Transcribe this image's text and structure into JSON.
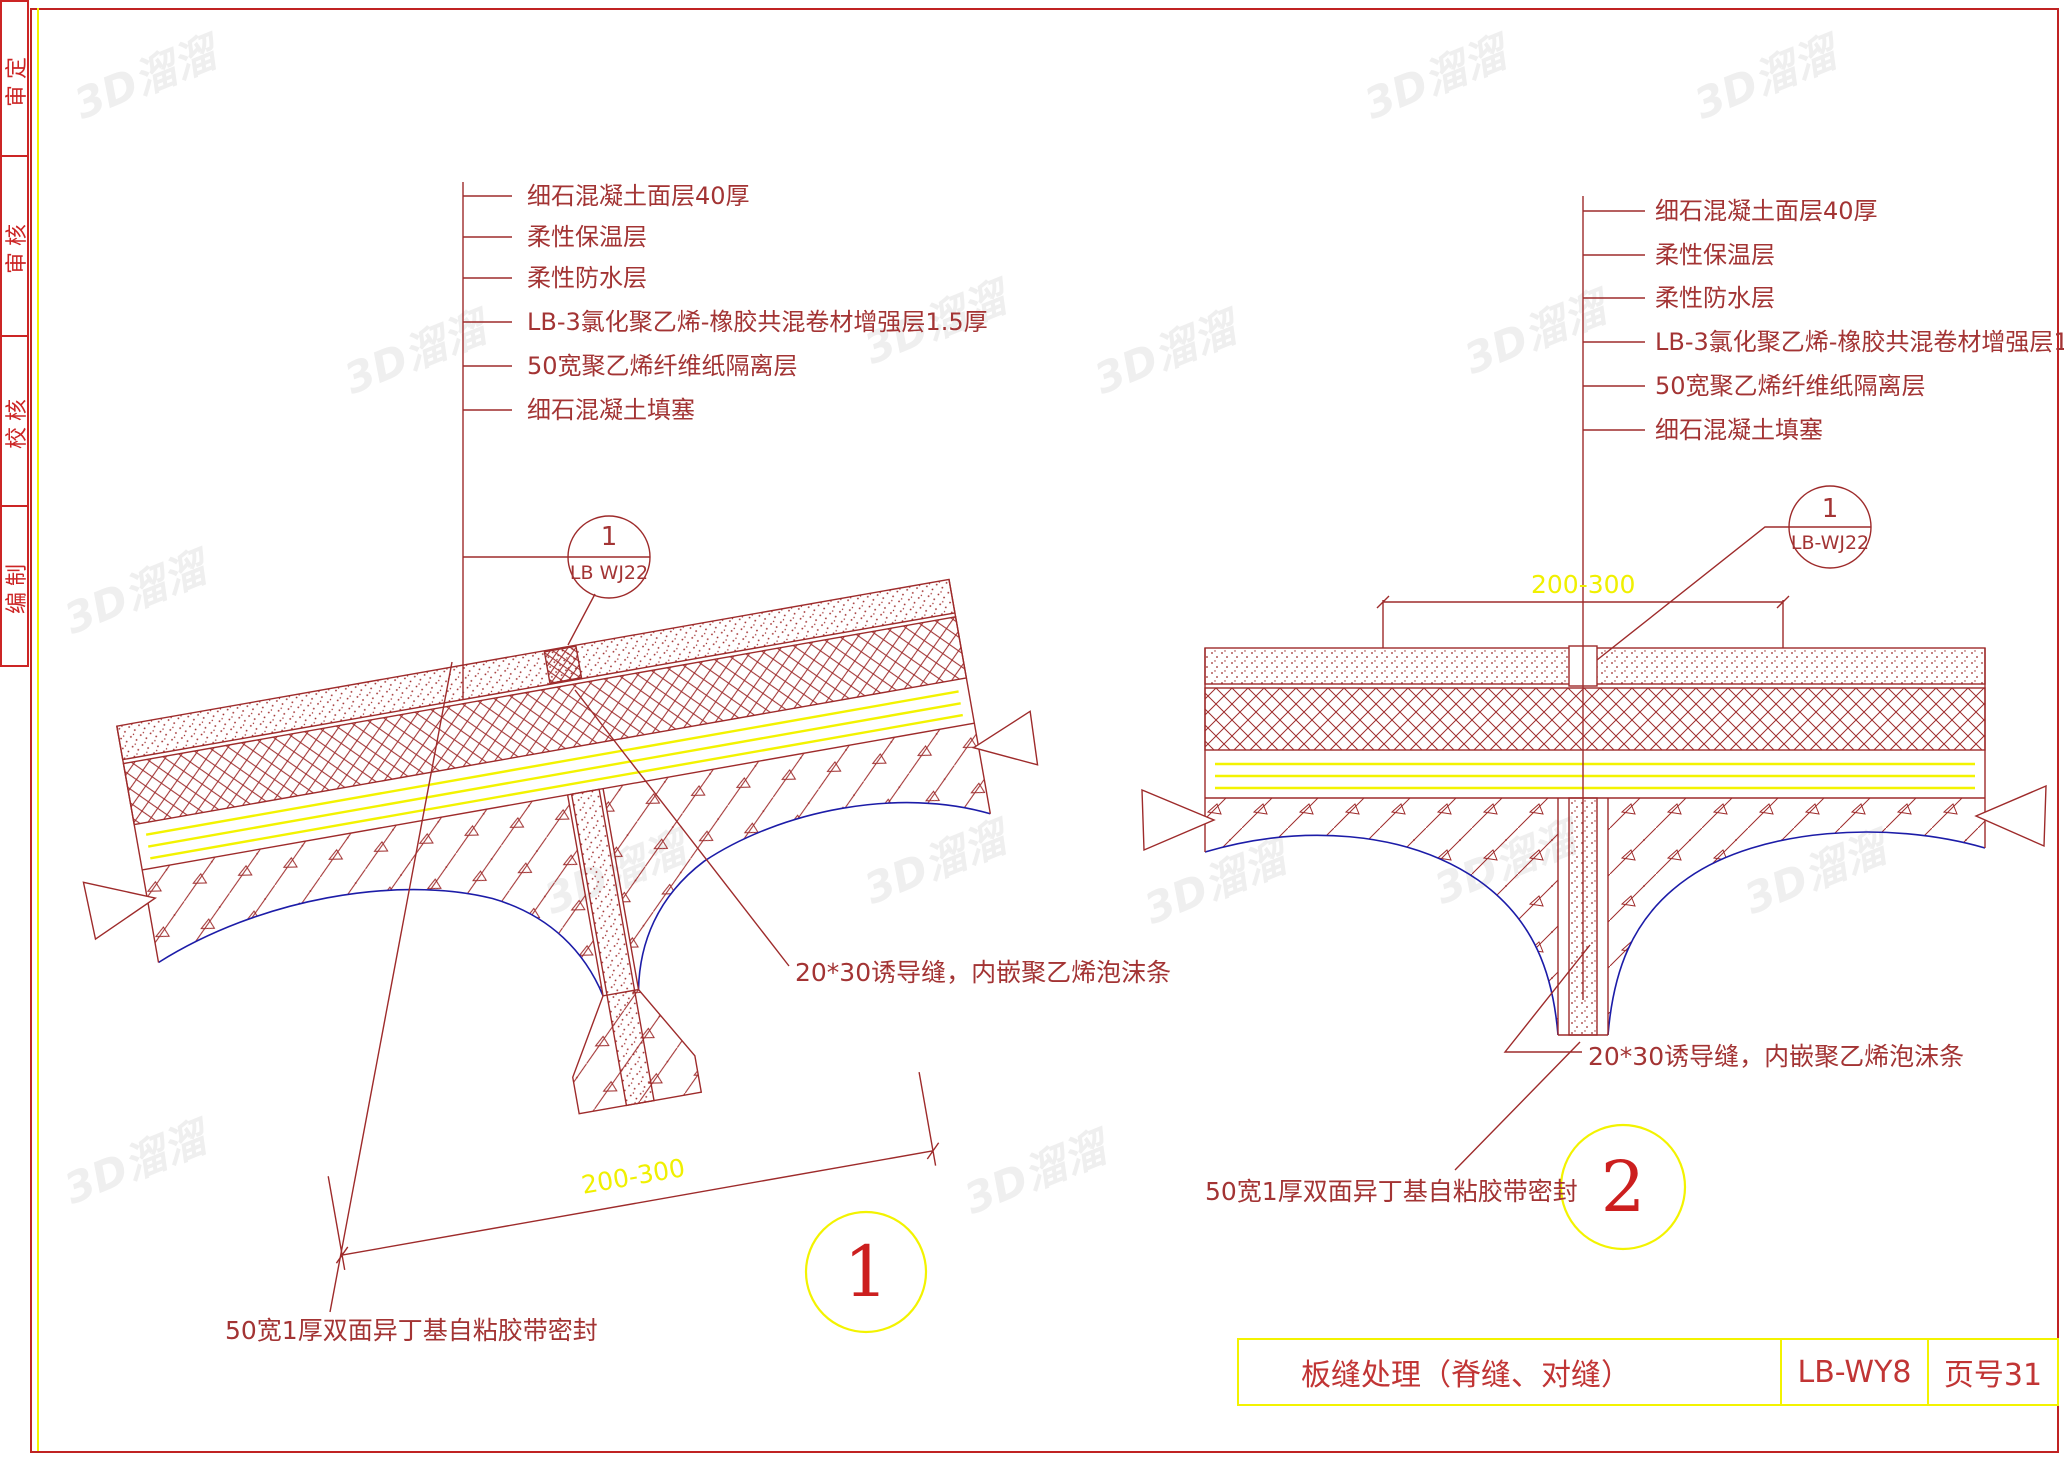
{
  "colors": {
    "line_red": "#9e2b2b",
    "text_red": "#a33434",
    "frame_red": "#c02323",
    "yellow": "#f3f300",
    "blue": "#1c1ca8",
    "watermark_gray": "#efefef"
  },
  "frame": {
    "sidebar_labels": [
      "审定",
      "审核",
      "校核",
      "编制"
    ]
  },
  "watermark": {
    "text": "3D溜溜"
  },
  "detail1": {
    "number": "1",
    "layer_labels": [
      "细石混凝土面层40厚",
      "柔性保温层",
      "柔性防水层",
      "LB-3氯化聚乙烯-橡胶共混卷材增强层1.5厚",
      "50宽聚乙烯纤维纸隔离层",
      "细石混凝土填塞"
    ],
    "callout_top": "1",
    "callout_bottom": "LB WJ22",
    "dimension": "200-300",
    "joint_note": "20*30诱导缝，内嵌聚乙烯泡沫条",
    "tape_note": "50宽1厚双面异丁基自粘胶带密封"
  },
  "detail2": {
    "number": "2",
    "layer_labels": [
      "细石混凝土面层40厚",
      "柔性保温层",
      "柔性防水层",
      "LB-3氯化聚乙烯-橡胶共混卷材增强层1.5厚",
      "50宽聚乙烯纤维纸隔离层",
      "细石混凝土填塞"
    ],
    "callout_top": "1",
    "callout_bottom": "LB-WJ22",
    "dimension": "200-300",
    "joint_note": "20*30诱导缝，内嵌聚乙烯泡沫条",
    "tape_note": "50宽1厚双面异丁基自粘胶带密封"
  },
  "title_block": {
    "title": "板缝处理（脊缝、对缝）",
    "code": "LB-WY8",
    "page": "页号31"
  }
}
